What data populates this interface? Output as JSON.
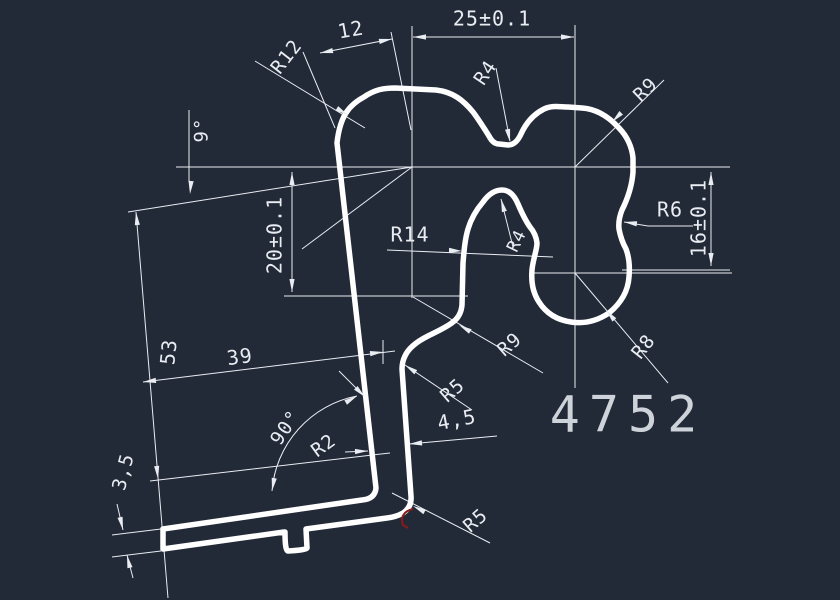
{
  "title": "CAD profile cross-section drawing",
  "part_number": "4752",
  "colors": {
    "background": "#222937",
    "profile_line": "#ffffff",
    "thin_line": "#e9edf2",
    "text": "#e9edf2",
    "part_number_text": "#ced3da",
    "highlight_red": "#8b1a1a"
  },
  "labels": {
    "d12": "12",
    "d25": "25±0.1",
    "r12": "R12",
    "r4_top": "R4",
    "r9_top": "R9",
    "a9": "9°",
    "d20": "20±0.1",
    "r14": "R14",
    "r4_inner": "R4",
    "r6": "R6",
    "d16": "16±0.1",
    "r8": "R8",
    "r9_lower": "R9",
    "r5_mid": "R5",
    "d45": "4,5",
    "d39": "39",
    "d53": "53",
    "a90": "90°",
    "r2": "R2",
    "d35": "3,5",
    "r5_bottom": "R5"
  }
}
